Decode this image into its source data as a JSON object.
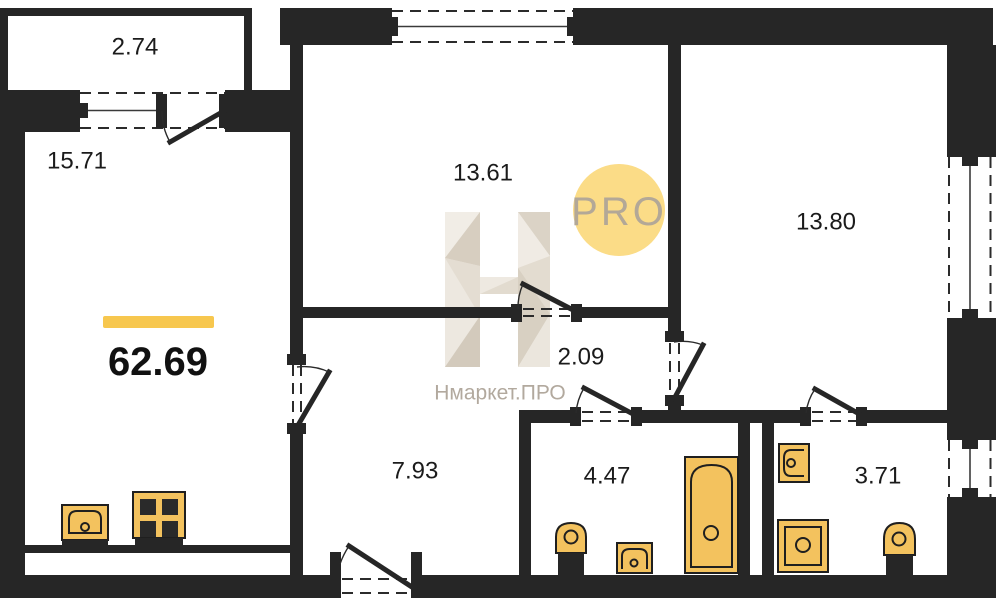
{
  "plan": {
    "total_area_label": "62.69",
    "rooms": [
      {
        "name": "balcony",
        "area_label": "2.74"
      },
      {
        "name": "living-room",
        "area_label": "15.71"
      },
      {
        "name": "bedroom-top-middle",
        "area_label": "13.61"
      },
      {
        "name": "bedroom-top-right",
        "area_label": "13.80"
      },
      {
        "name": "hall",
        "area_label": "2.09"
      },
      {
        "name": "corridor",
        "area_label": "7.93"
      },
      {
        "name": "bathroom",
        "area_label": "4.47"
      },
      {
        "name": "toilet-bathroom",
        "area_label": "3.71"
      }
    ],
    "watermark": {
      "brand_text": "Нмаркет.ПРО",
      "badge_text": "PRO"
    },
    "colors": {
      "wall": "#262626",
      "fixture_fill": "#F3C25E",
      "accent_bar": "#F7C74E",
      "badge_fill": "#FBDC87",
      "badge_text": "#B3A897",
      "watermark_base": "#E9E3DA",
      "label_text": "#1B1B1B"
    }
  }
}
